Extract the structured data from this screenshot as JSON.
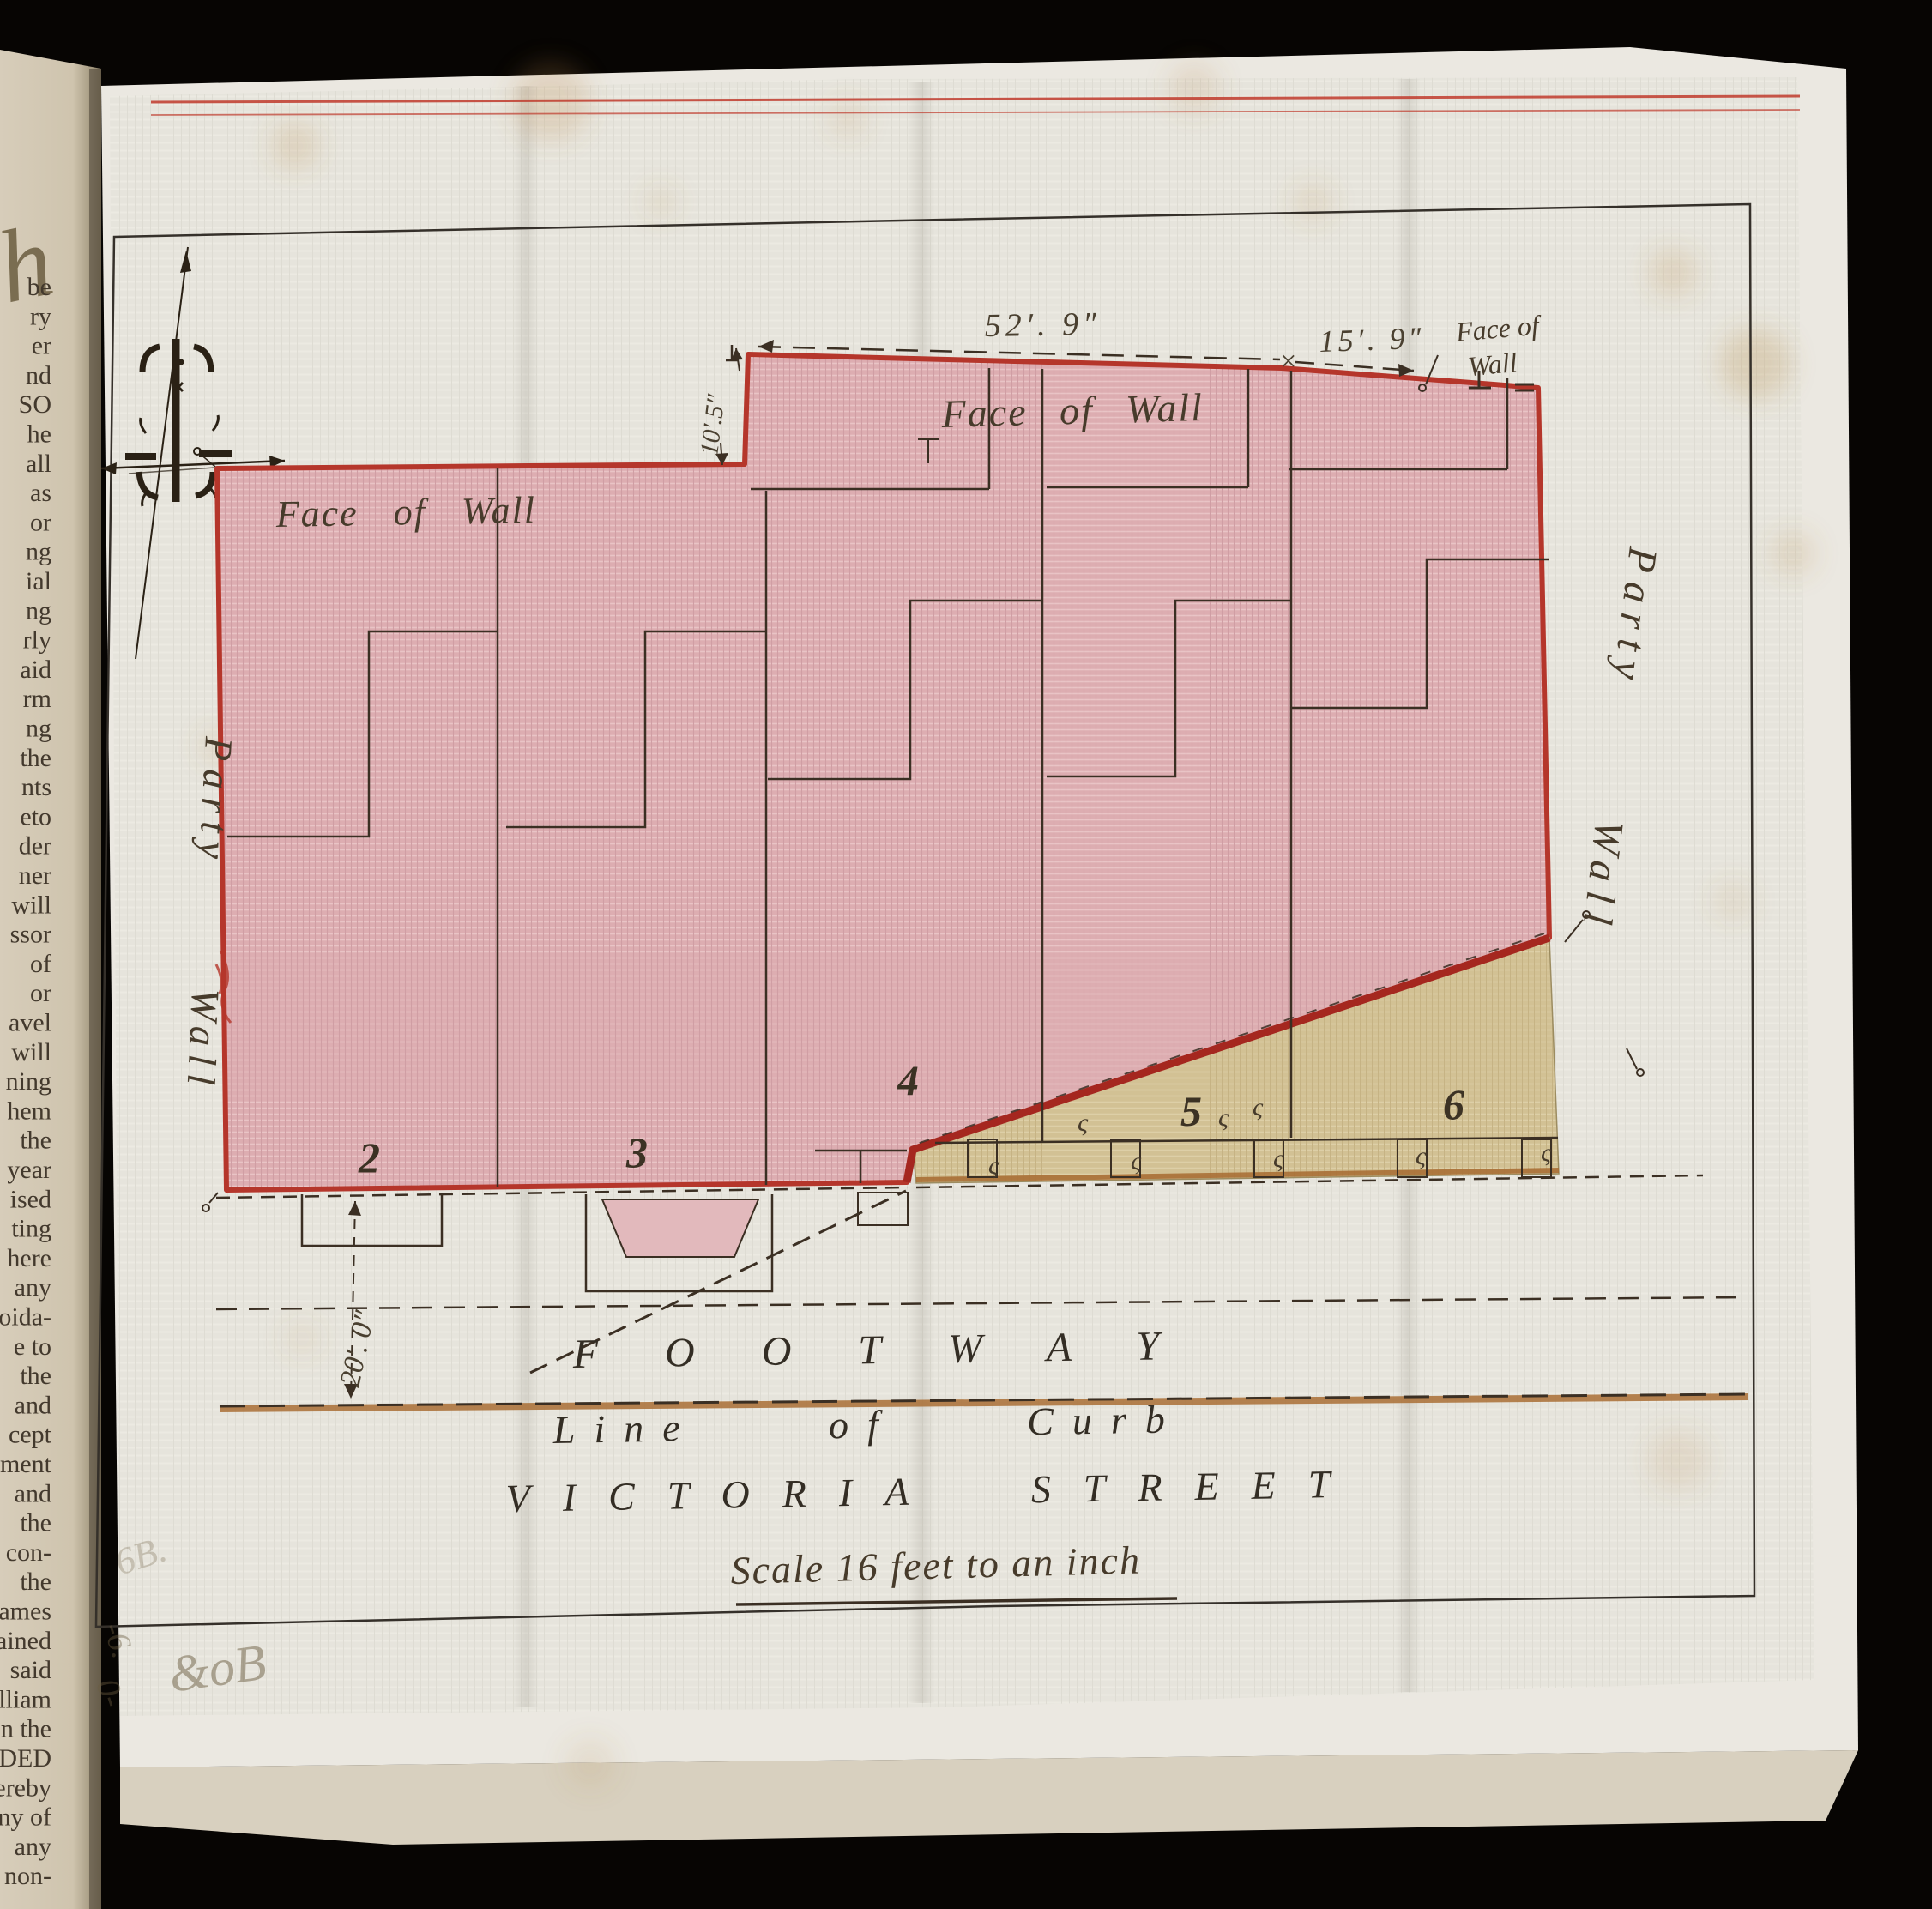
{
  "book_page": {
    "script_flourish": "h",
    "fragments": [
      "be",
      "ry",
      "er",
      "nd",
      "SO",
      "he",
      "all",
      "as",
      "or",
      "ng",
      "ial",
      "ng",
      "rly",
      "aid",
      "rm",
      "ng",
      "the",
      "nts",
      "eto",
      "der",
      "ner",
      "will",
      "ssor",
      "of",
      "or",
      "avel",
      "will",
      "ning",
      "hem",
      "the",
      "year",
      "ised",
      "ting",
      "here",
      "any",
      "oida-",
      "e to",
      "the",
      "and",
      "cept",
      "ment",
      "and",
      "the",
      "con-",
      "the",
      "ames",
      "ained",
      "said",
      "lliam",
      "n the",
      "DED",
      "ereby",
      "ny of",
      "any",
      "non-"
    ]
  },
  "plan": {
    "street_name": "VICTORIA STREET",
    "footway_label": "FOOTWAY",
    "curb_label": "Line of Curb",
    "scale_note": "Scale 16 feet to an inch",
    "labels": {
      "face_of_wall_left": "Face of Wall",
      "face_of_wall_top": "Face of Wall",
      "face_of_wall_right_line1": "Face of",
      "face_of_wall_right_line2": "Wall",
      "party_wall_left": "Party Wall",
      "party_wall_right": "Party Wall"
    },
    "dimensions": {
      "frontage_main": "52′. 9″",
      "frontage_right": "15′. 9″",
      "wall_step": "10′.5″",
      "footway_width": "20′. 0″",
      "dim_cross": "×"
    },
    "plots": [
      {
        "number": "2"
      },
      {
        "number": "3"
      },
      {
        "number": "4"
      },
      {
        "number": "5"
      },
      {
        "number": "6"
      }
    ],
    "section_mark": "ς",
    "handwritten": {
      "mark1": "&oB",
      "mark2": "-6.",
      "mark3": "0-",
      "mark4": "6B."
    },
    "colors": {
      "plot_fill": "#dfb0b4",
      "yard_fill": "#d4c498",
      "boundary_red": "#b5372b",
      "curb_brown": "#a96f35",
      "ink": "#3a3026"
    }
  }
}
